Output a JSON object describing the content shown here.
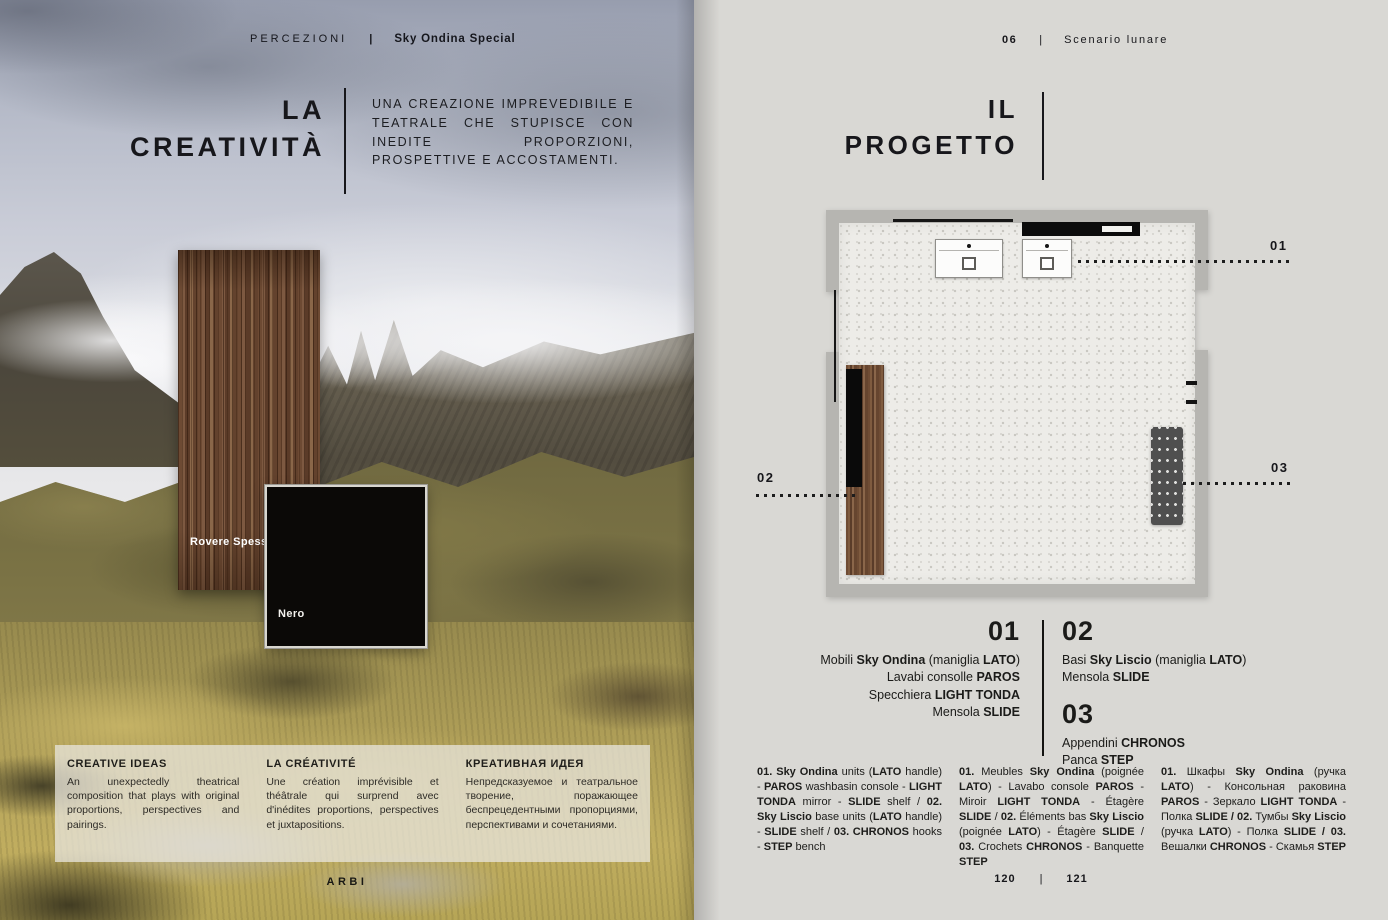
{
  "colors": {
    "accent_black": "#111111",
    "page_grey": "#d9d8d4",
    "wall_grey": "#b6b5b1",
    "wood_brown": "#6f4c34"
  },
  "left_page": {
    "header": {
      "section": "PERCEZIONI",
      "separator": "|",
      "edition": "Sky Ondina Special"
    },
    "title": {
      "line1": "LA",
      "line2": "CREATIVITÀ"
    },
    "intro": "UNA CREAZIONE IMPREVEDIBILE E TEATRALE CHE STUPISCE CON INEDITE PROPORZIONI, PROSPETTIVE E ACCOSTAMENTI.",
    "samples": {
      "wood": "Rovere Spessart",
      "black": "Nero"
    },
    "captions": [
      {
        "title": "CREATIVE IDEAS",
        "body": "An unexpectedly theatrical composition that plays with original proportions, perspectives and pairings."
      },
      {
        "title": "LA CRÉATIVITÉ",
        "body": "Une création imprévisible et théâtrale qui surprend avec d'inédites proportions, perspectives et juxtapositions."
      },
      {
        "title": "КРЕАТИВНАЯ ИДЕЯ",
        "body": "Непредсказуемое и театральное творение, поражающее беспрецедентными пропорциями, перспективами и сочетаниями."
      }
    ],
    "brand": "ARBI"
  },
  "right_page": {
    "header": {
      "number": "06",
      "separator": "|",
      "chapter": "Scenario lunare"
    },
    "title": {
      "line1": "IL",
      "line2": "PROGETTO"
    },
    "plan": {
      "callout_01": "01",
      "callout_02": "02",
      "callout_03": "03"
    },
    "legend": {
      "item1": {
        "number": "01",
        "lines": [
          [
            {
              "t": "Mobili "
            },
            {
              "t": "Sky Ondina",
              "b": true
            },
            {
              "t": " (maniglia "
            },
            {
              "t": "LATO",
              "b": true
            },
            {
              "t": ")"
            }
          ],
          [
            {
              "t": "Lavabi consolle "
            },
            {
              "t": "PAROS",
              "b": true
            }
          ],
          [
            {
              "t": "Specchiera "
            },
            {
              "t": "LIGHT TONDA",
              "b": true
            }
          ],
          [
            {
              "t": "Mensola "
            },
            {
              "t": "SLIDE",
              "b": true
            }
          ]
        ]
      },
      "item2": {
        "number": "02",
        "lines": [
          [
            {
              "t": "Basi "
            },
            {
              "t": "Sky Liscio",
              "b": true
            },
            {
              "t": " (maniglia "
            },
            {
              "t": "LATO",
              "b": true
            },
            {
              "t": ")"
            }
          ],
          [
            {
              "t": "Mensola "
            },
            {
              "t": "SLIDE",
              "b": true
            }
          ]
        ]
      },
      "item3": {
        "number": "03",
        "lines": [
          [
            {
              "t": "Appendini "
            },
            {
              "t": "CHRONOS",
              "b": true
            }
          ],
          [
            {
              "t": "Panca "
            },
            {
              "t": "STEP",
              "b": true
            }
          ]
        ]
      }
    },
    "footnotes": [
      [
        {
          "t": "01. Sky Ondina",
          "b": true
        },
        {
          "t": " units ("
        },
        {
          "t": "LATO",
          "b": true
        },
        {
          "t": " handle) - "
        },
        {
          "t": "PAROS",
          "b": true
        },
        {
          "t": " washbasin console - "
        },
        {
          "t": "LIGHT TONDA",
          "b": true
        },
        {
          "t": " mirror - "
        },
        {
          "t": "SLIDE",
          "b": true
        },
        {
          "t": " shelf / "
        },
        {
          "t": "02. Sky Liscio",
          "b": true
        },
        {
          "t": " base units ("
        },
        {
          "t": "LATO",
          "b": true
        },
        {
          "t": " handle) - "
        },
        {
          "t": "SLIDE",
          "b": true
        },
        {
          "t": " shelf / "
        },
        {
          "t": "03. CHRONOS",
          "b": true
        },
        {
          "t": " hooks - "
        },
        {
          "t": "STEP",
          "b": true
        },
        {
          "t": " bench"
        }
      ],
      [
        {
          "t": "01.",
          "b": true
        },
        {
          "t": " Meubles "
        },
        {
          "t": "Sky Ondina",
          "b": true
        },
        {
          "t": " (poignée "
        },
        {
          "t": "LATO",
          "b": true
        },
        {
          "t": ") - Lavabo console "
        },
        {
          "t": "PAROS",
          "b": true
        },
        {
          "t": " - Miroir "
        },
        {
          "t": "LIGHT TONDA",
          "b": true
        },
        {
          "t": " - Étagère "
        },
        {
          "t": "SLIDE",
          "b": true
        },
        {
          "t": " / "
        },
        {
          "t": "02.",
          "b": true
        },
        {
          "t": " Éléments bas "
        },
        {
          "t": "Sky Liscio",
          "b": true
        },
        {
          "t": " (poignée "
        },
        {
          "t": "LATO",
          "b": true
        },
        {
          "t": ") - Étagère "
        },
        {
          "t": "SLIDE",
          "b": true
        },
        {
          "t": " / "
        },
        {
          "t": "03.",
          "b": true
        },
        {
          "t": " Crochets "
        },
        {
          "t": "CHRONOS",
          "b": true
        },
        {
          "t": " - Banquette "
        },
        {
          "t": "STEP",
          "b": true
        }
      ],
      [
        {
          "t": "01.",
          "b": true
        },
        {
          "t": " Шкафы "
        },
        {
          "t": "Sky Ondina",
          "b": true
        },
        {
          "t": " (ручка "
        },
        {
          "t": "LATO",
          "b": true
        },
        {
          "t": ") - Консольная раковина "
        },
        {
          "t": "PAROS",
          "b": true
        },
        {
          "t": " - Зеркало "
        },
        {
          "t": "LIGHT TONDA",
          "b": true
        },
        {
          "t": " - Полка "
        },
        {
          "t": "SLIDE / 02.",
          "b": true
        },
        {
          "t": " Тумбы "
        },
        {
          "t": "Sky Liscio",
          "b": true
        },
        {
          "t": " (ручка "
        },
        {
          "t": "LATO",
          "b": true
        },
        {
          "t": ") - Полка "
        },
        {
          "t": "SLIDE / 03.",
          "b": true
        },
        {
          "t": " Вешалки "
        },
        {
          "t": "CHRONOS",
          "b": true
        },
        {
          "t": " - Скамья "
        },
        {
          "t": "STEP",
          "b": true
        }
      ]
    ],
    "footer": {
      "page_left": "120",
      "separator": "|",
      "page_right": "121"
    }
  }
}
